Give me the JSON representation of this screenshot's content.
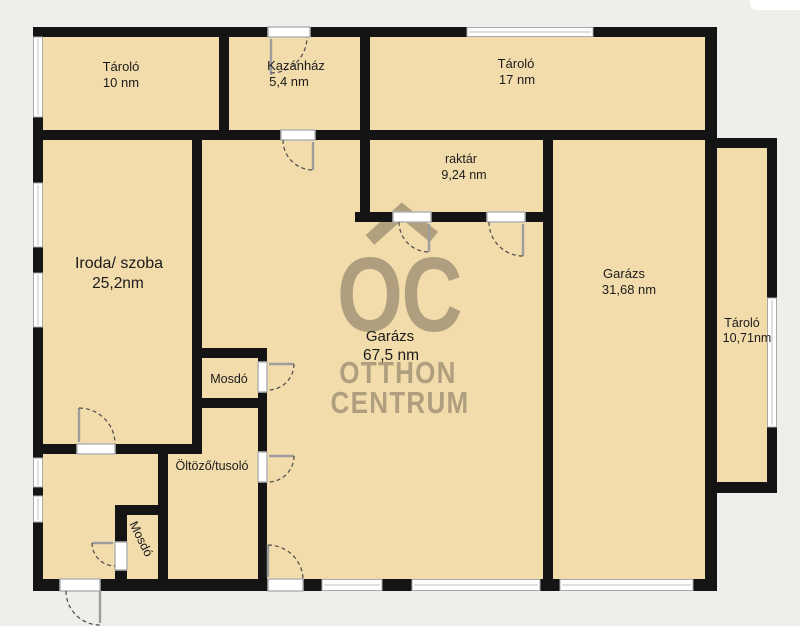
{
  "plan": {
    "rooms": {
      "tarolo10": {
        "name": "Tároló",
        "area": "10 nm"
      },
      "kazanhaz": {
        "name": "Kazánház",
        "area": "5,4 nm"
      },
      "tarolo17": {
        "name": "Tároló",
        "area": "17 nm"
      },
      "raktar": {
        "name": "raktár",
        "area": "9,24 nm"
      },
      "iroda": {
        "name": "Iroda/ szoba",
        "area": "25,2nm"
      },
      "garazsKozep": {
        "name": "Garázs",
        "area": "67,5 nm"
      },
      "garazsJobb": {
        "name": "Garázs",
        "area": "31,68 nm"
      },
      "tarolojobb": {
        "name": "Tároló",
        "area": "10,71nm"
      },
      "mosdo1": {
        "name": "Mosdó"
      },
      "oltozo": {
        "name": "Öltöző/tusoló"
      },
      "mosdo2": {
        "name": "Mosdó"
      }
    },
    "watermark": {
      "logo": "OC",
      "line1": "OTTHON",
      "line2": "CENTRUM"
    },
    "colors": {
      "floor": "#f3dcab",
      "wall": "#141414",
      "background": "#efeeea",
      "watermark": "#6f6452",
      "window_fill": "#ffffff",
      "door_jamb": "#b3b3b3"
    }
  }
}
